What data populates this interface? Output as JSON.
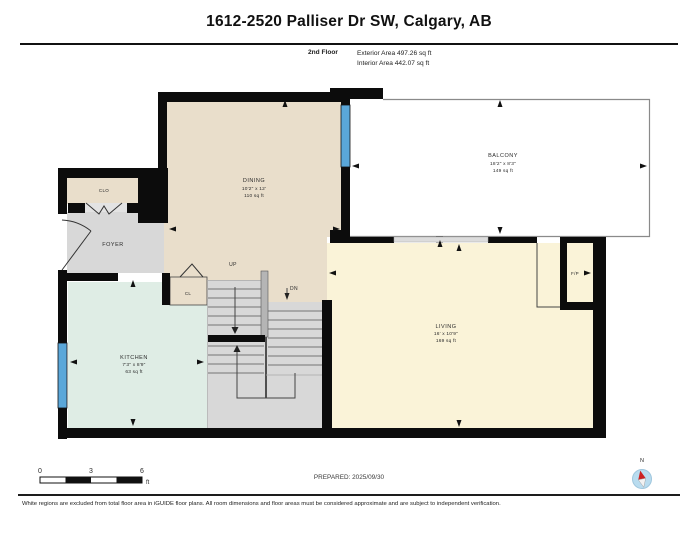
{
  "header": {
    "title": "1612-2520 Palliser Dr SW, Calgary, AB",
    "floor_label": "2nd Floor",
    "exterior_area": "Exterior Area 497.26 sq ft",
    "interior_area": "Interior Area 442.07 sq ft"
  },
  "rooms": {
    "dining": {
      "name": "DINING",
      "dims": "10'2\" x 12'",
      "area": "110 sq ft"
    },
    "balcony": {
      "name": "BALCONY",
      "dims": "18'2\" x 8'3\"",
      "area": "149 sq ft"
    },
    "kitchen": {
      "name": "KITCHEN",
      "dims": "7'3\" x 8'9\"",
      "area": "63 sq ft"
    },
    "living": {
      "name": "LIVING",
      "dims": "16' x 10'9\"",
      "area": "169 sq ft"
    },
    "foyer": {
      "name": "FOYER"
    },
    "closet": {
      "name": "CLO"
    },
    "closet_small": {
      "name": "CL"
    },
    "fireplace": {
      "name": "F/P"
    },
    "stairs_up_label": "UP",
    "stairs_down_label": "DN"
  },
  "footer": {
    "scale_ticks": {
      "zero": "0",
      "three": "3",
      "six": "6"
    },
    "scale_unit": "ft",
    "prepared": "PREPARED: 2025/09/30",
    "compass_north": "N",
    "disclaimer": "White regions are excluded from total floor area in iGUIDE floor plans. All room dimensions and floor areas must be considered approximate and are subject to independent verification."
  },
  "colors": {
    "room_beige": "#e9decb",
    "room_gray": "#d8d8d8",
    "room_mint": "#dfede5",
    "room_yellow": "#faf3d8",
    "window_blue": "#5aa7d9",
    "wall_black": "#0c0c0c",
    "compass_blue": "#b9dcef",
    "needle_red": "#cc2222"
  }
}
